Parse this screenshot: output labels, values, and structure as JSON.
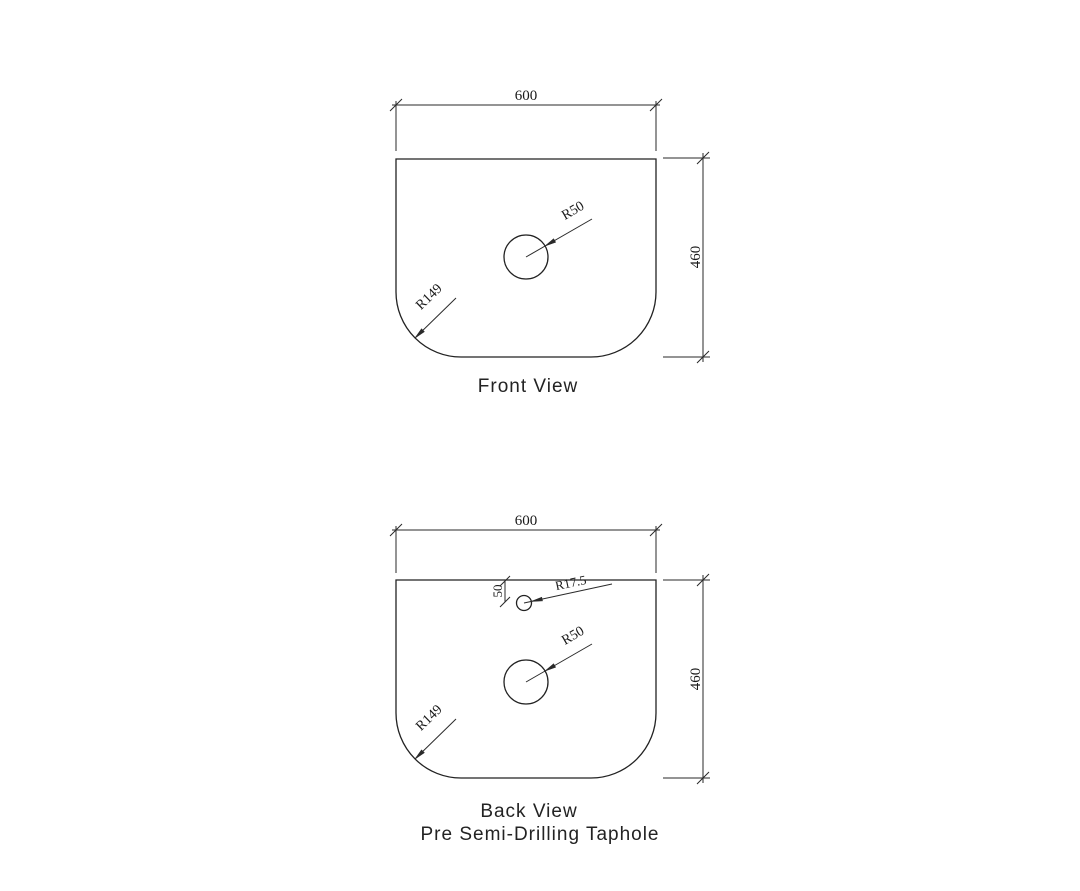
{
  "colors": {
    "background": "#ffffff",
    "line": "#222222",
    "text": "#1a1a1a"
  },
  "front_view": {
    "title": "Front View",
    "width_mm": "600",
    "height_mm": "460",
    "hole_radius": "R50",
    "corner_radius": "R149"
  },
  "back_view": {
    "title": "Back View",
    "subtitle": "Pre Semi-Drilling Taphole",
    "width_mm": "600",
    "height_mm": "460",
    "hole_radius": "R50",
    "corner_radius": "R149",
    "taphole_radius": "R17.5",
    "taphole_offset_mm": "50"
  }
}
